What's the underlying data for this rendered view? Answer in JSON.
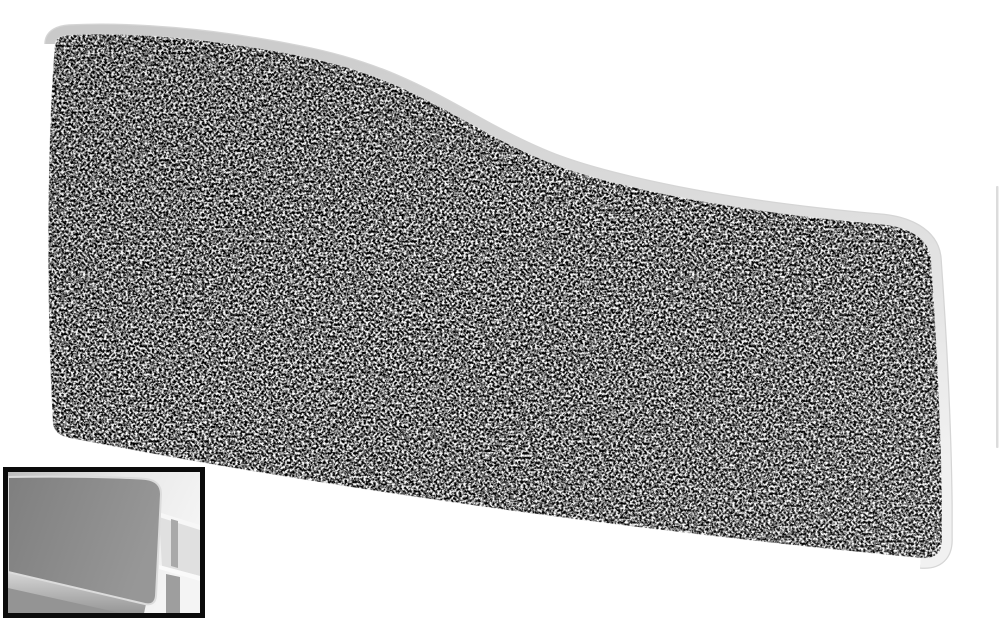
{
  "page": {
    "background": "#ffffff"
  },
  "product_image": {
    "label": "wave-top-acoustic-desk-screen",
    "adjacent_edge": "#dcdcdc",
    "fabric": {
      "base": "#6f6f6f",
      "fleck_dark": "#151515",
      "fleck_light": "#f5f5f5",
      "edge_highlight": "#f5f5f5"
    },
    "trim": {
      "outline": "#ababab",
      "light": "#c9c9c9",
      "bright": "#f1f1f1"
    }
  },
  "thumbnail": {
    "label": "screen-mounted-on-desk-photo",
    "frame": "#0b0b0b",
    "photo": {
      "bg_left": "#bdbdbd",
      "bg_mid": "#e8e8e8",
      "bg_right": "#f4f4f4",
      "panel_dark": "#7f7f7f",
      "panel_light": "#979797",
      "panel_trim": "#dcdcdc",
      "rail_light": "#d9d9d9",
      "rail_dark": "#8f8f8f",
      "desk_top": "#f7f7f7",
      "desk_side": "#e0e0e0",
      "desk_edge": "#fafafa",
      "leg": "#9e9e9e",
      "leg_rear": "#a9a9a9",
      "leg_back": "#8a8a8a",
      "floor_shadow": "#949494"
    }
  }
}
